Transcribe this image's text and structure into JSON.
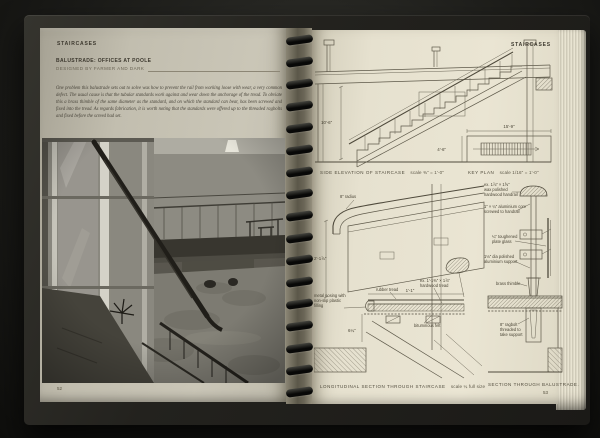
{
  "colors": {
    "cover": "#23221e",
    "left_page_paper": "#c2beaf",
    "right_page_paper": "#e6e1cf",
    "ink": "#3c382e",
    "photo_dark": "#23211c"
  },
  "left_page": {
    "running_head": "STAIRCASES",
    "title": "BALUSTRADE: OFFICES AT POOLE",
    "byline": "DESIGNED BY FARMER AND DARK",
    "intro": "One problem this balustrade sets out to solve was how to prevent the rail from working loose with wear, a very common defect. The usual cause is that the tubular standards work against and wear down the anchorage of the tread. To obviate this a brass thimble of the same diameter as the standard, and on which the standard can bear, has been screwed and fixed into the tread. As regards fabrication, it is worth noting that the standards were offered up to the threaded ragbolts and fixed before the screed had set.",
    "page_number": "52"
  },
  "right_page": {
    "running_head": "STAIRCASES",
    "page_number": "53",
    "side_elevation": {
      "label": "SIDE ELEVATION OF STAIRCASE",
      "scale": "scale ⅜\" = 1'-0\"",
      "dim_height": "10'-6\""
    },
    "key_plan": {
      "label": "KEY PLAN",
      "scale": "scale 1/16\" = 1'-0\"",
      "dim_length": "15'-9\"",
      "dim_width": "4'-6\""
    },
    "long_section": {
      "label": "LONGITUDINAL SECTION THROUGH STAIRCASE",
      "scale": "scale ¼ full size",
      "ann": {
        "radius": "8\" radius",
        "glass_height": "2'-1⅞\"",
        "nosing_l1": "metal nosing with",
        "nosing_l2": "non-slip plastic",
        "nosing_l3": "filling",
        "rubber_tread": "rubber tread",
        "tread_l1": "ex. 1'-1⅜\" × 1⅞\"",
        "tread_l2": "hardwood tread",
        "tread_width": "1'-1\"",
        "felt": "bituminous felt",
        "riser": "6¼\""
      }
    },
    "balustrade_section": {
      "label": "SECTION THROUGH BALUSTRADE.",
      "ann": {
        "handrail_l1": "ex. 1⅞\" × 1⅝\"",
        "handrail_l2": "wax polished",
        "handrail_l3": "hardwood handrail",
        "core_l1": "1\" × ¼\" aluminium core",
        "core_l2": "screwed to handrail",
        "glass_l1": "¼\" toughened",
        "glass_l2": "plate glass",
        "support_l1": "1⅛\" dia polished",
        "support_l2": "aluminium support",
        "thimble": "brass thimble",
        "ragbolt_l1": "8\" ragbolt",
        "ragbolt_l2": "threaded to",
        "ragbolt_l3": "take support"
      }
    }
  }
}
